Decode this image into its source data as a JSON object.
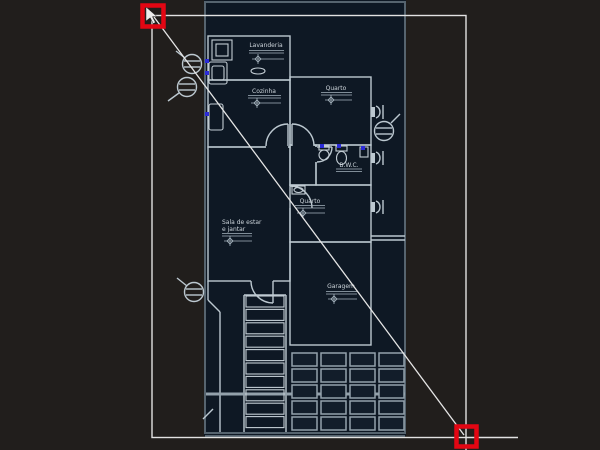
{
  "rooms": {
    "lavanderia": "Lavanderia",
    "cozinha": "Cozinha",
    "quarto_top": "Quarto",
    "bwc": "B.W.C.",
    "quarto_mid": "Quarto",
    "sala_line1": "Sala de estar",
    "sala_line2": "e jantar",
    "garagem": "Garagem"
  },
  "colors": {
    "canvas_background": "#211e1c",
    "lot_background": "#0e1824",
    "boundary": "#56646f",
    "wall": "#bcc8d0",
    "selection_line": "#e2e2e2",
    "hot_grip": "#e30613",
    "object_grip": "#2b2bd8",
    "text": "#ccd4da"
  }
}
